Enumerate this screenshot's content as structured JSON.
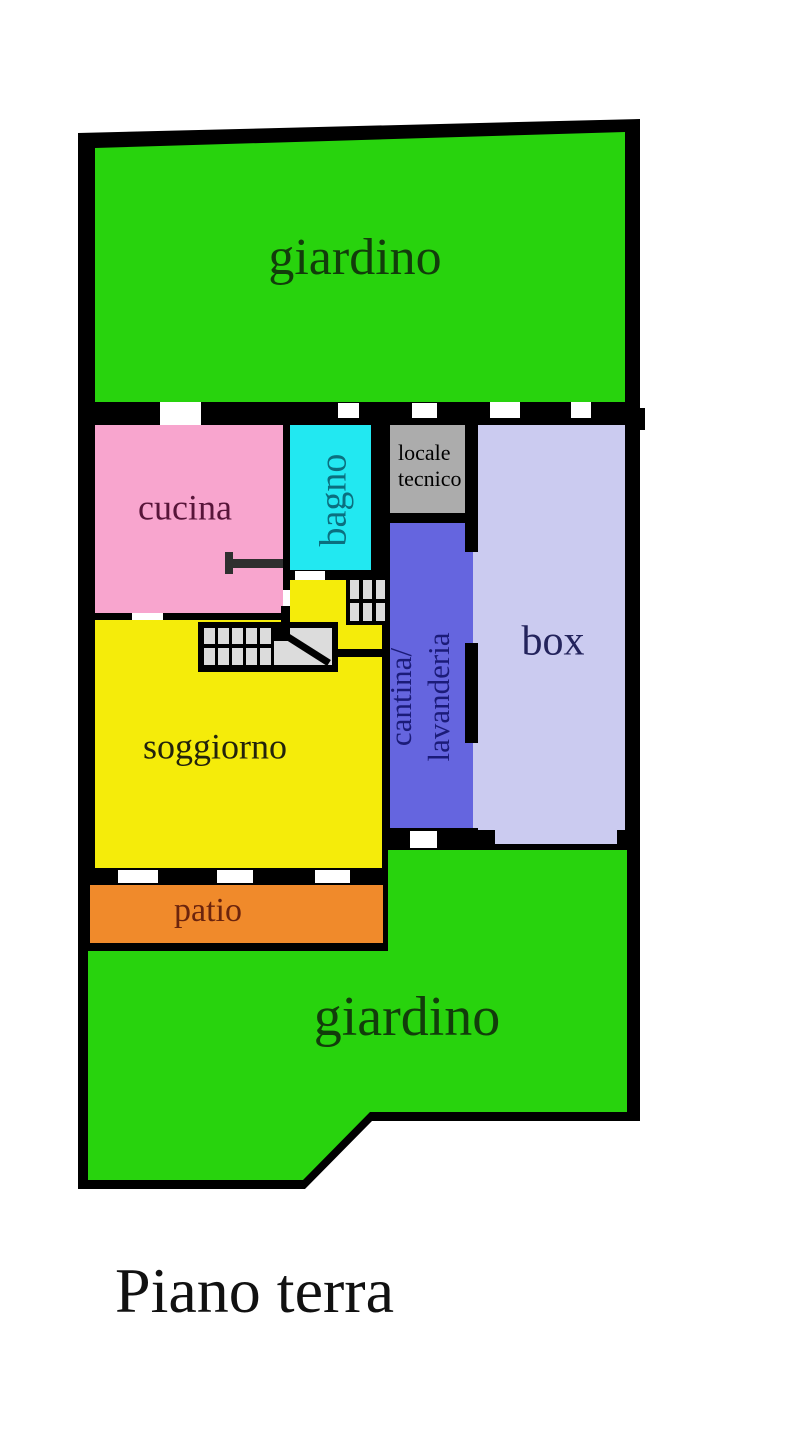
{
  "title": {
    "text": "Piano terra"
  },
  "rooms": {
    "garden_top": {
      "label": "giardino"
    },
    "cucina": {
      "label": "cucina"
    },
    "bagno": {
      "label": "bagno"
    },
    "locale_tecnico": {
      "line1": "locale",
      "line2": "tecnico"
    },
    "box": {
      "label": "box"
    },
    "cantina": {
      "line1": "cantina/",
      "line2": "lavanderia"
    },
    "soggiorno": {
      "label": "soggiorno"
    },
    "patio": {
      "label": "patio"
    },
    "garden_bottom": {
      "label": "giardino"
    }
  },
  "colors": {
    "wall": "#000000",
    "opening": "#FFFFFF",
    "garden": "#28D30D",
    "garden_label": "#123D0B",
    "cucina": "#F8A5CE",
    "cucina_label": "#571539",
    "bagno": "#22E8F1",
    "bagno_label": "#0B6F7F",
    "locale": "#ACACAC",
    "locale_label": "#000000",
    "box": "#CBCBF0",
    "box_label": "#23235C",
    "cantina": "#6565DF",
    "cantina_label": "#1B1B78",
    "soggiorno": "#F5EC0A",
    "soggiorno_label": "#23230C",
    "patio": "#F08A2B",
    "patio_label": "#6B240D",
    "stair_tread": "#DCDCDC",
    "inner_wall": "#2F2F2F",
    "title": "#111111"
  }
}
